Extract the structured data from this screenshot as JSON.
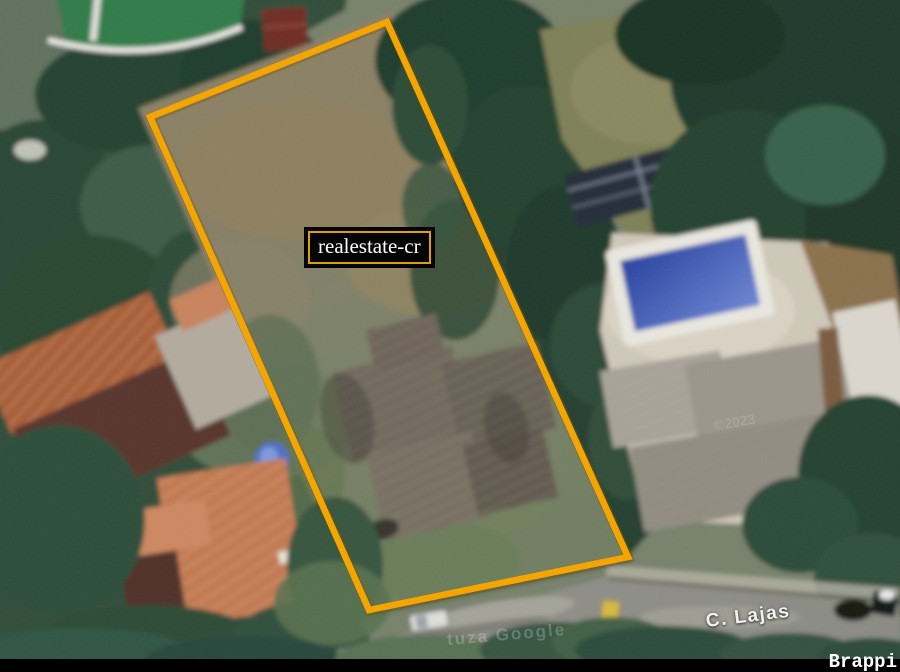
{
  "window": {
    "width": 900,
    "height": 672
  },
  "overlay": {
    "property_label": "realestate-cr",
    "street_label": "C. Lajas",
    "imagery_watermark": "tuza Google",
    "year_watermark": "©2023",
    "brand_watermark": "Brappi"
  },
  "colors": {
    "boundary_outline": "#F3A602",
    "label_background": "#050505",
    "label_border": "#DFA100",
    "label_text": "#FFFFFF",
    "street_text": "#F2F2F0",
    "bottom_bar": "#000000",
    "brand_text": "#FFFFFF",
    "pool_water": "#3B55B5"
  }
}
